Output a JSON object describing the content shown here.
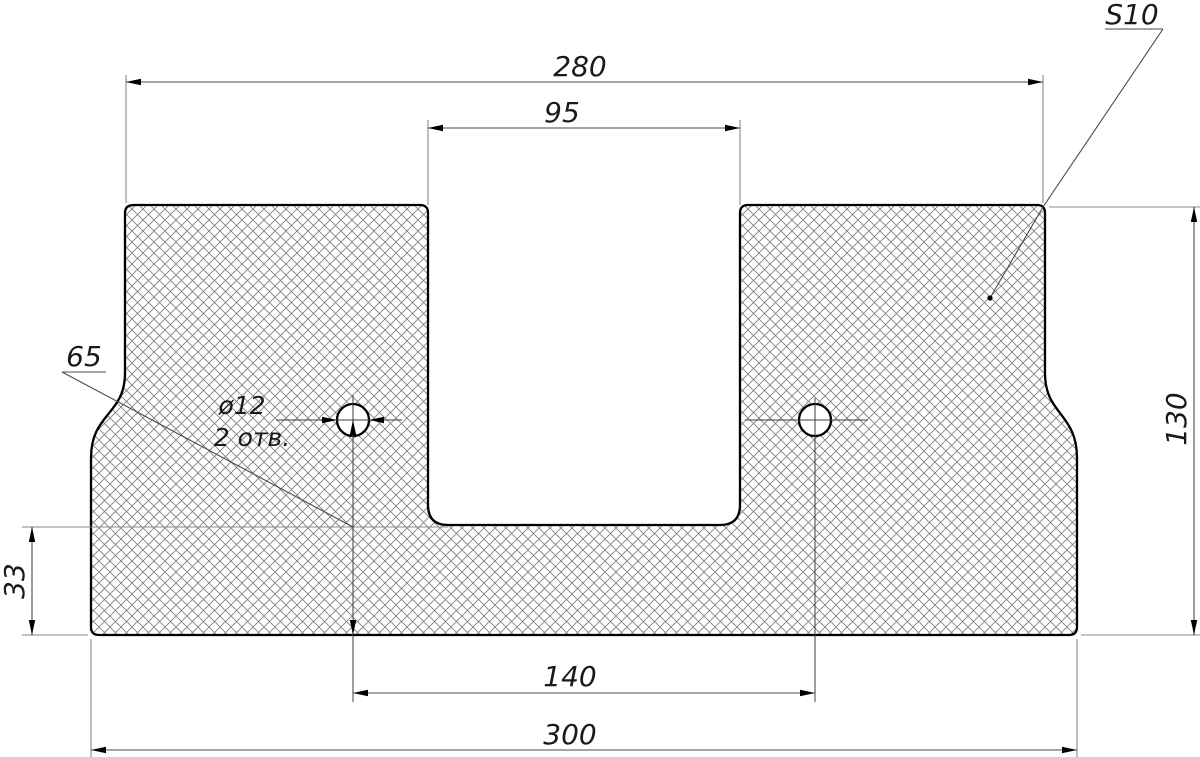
{
  "drawing": {
    "type": "technical-drawing-cross-section",
    "dimensions": {
      "overall_width_top": "280",
      "slot_width": "95",
      "overall_height": "130",
      "base_height": "33",
      "hole_center_height": "65",
      "hole_spacing": "140",
      "overall_width_bottom": "300",
      "hole_diameter": "ø12",
      "hole_count": "2 отв.",
      "sheet_thickness": "S10"
    },
    "colors": {
      "outline": "#000000",
      "hatch": "#7c7c7c",
      "dimension_lines": "#4a4a4a",
      "extension_lines": "#8a8a8a",
      "text": "#1a1a1a",
      "background": "#ffffff"
    }
  }
}
